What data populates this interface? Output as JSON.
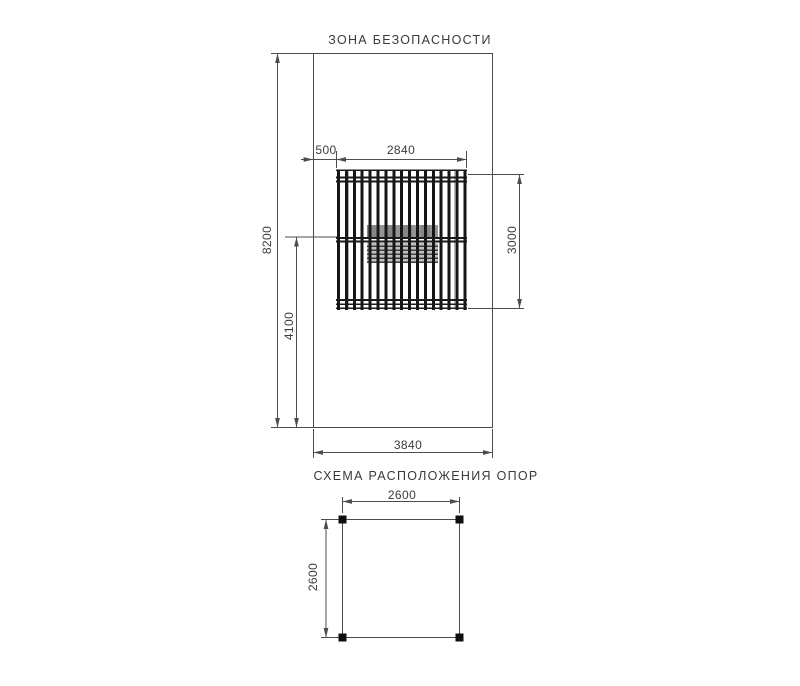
{
  "safety_zone_plan": {
    "title": "ЗОНА БЕЗОПАСНОСТИ",
    "dimensions": {
      "edge_offset_mm": "500",
      "equipment_width_mm": "2840",
      "equipment_depth_mm": "3000",
      "zone_length_mm": "8200",
      "zone_half_length_mm": "4100",
      "zone_width_mm": "3840"
    }
  },
  "support_layout_plan": {
    "title": "СХЕМА РАСПОЛОЖЕНИЯ ОПОР",
    "dimensions": {
      "span_x_mm": "2600",
      "span_y_mm": "2600"
    }
  },
  "colors": {
    "dimension_line": "#4d4d4d",
    "equipment_dark": "#191919",
    "seat_gray": "#8d8d8d",
    "label_text": "#3b3b3b"
  }
}
